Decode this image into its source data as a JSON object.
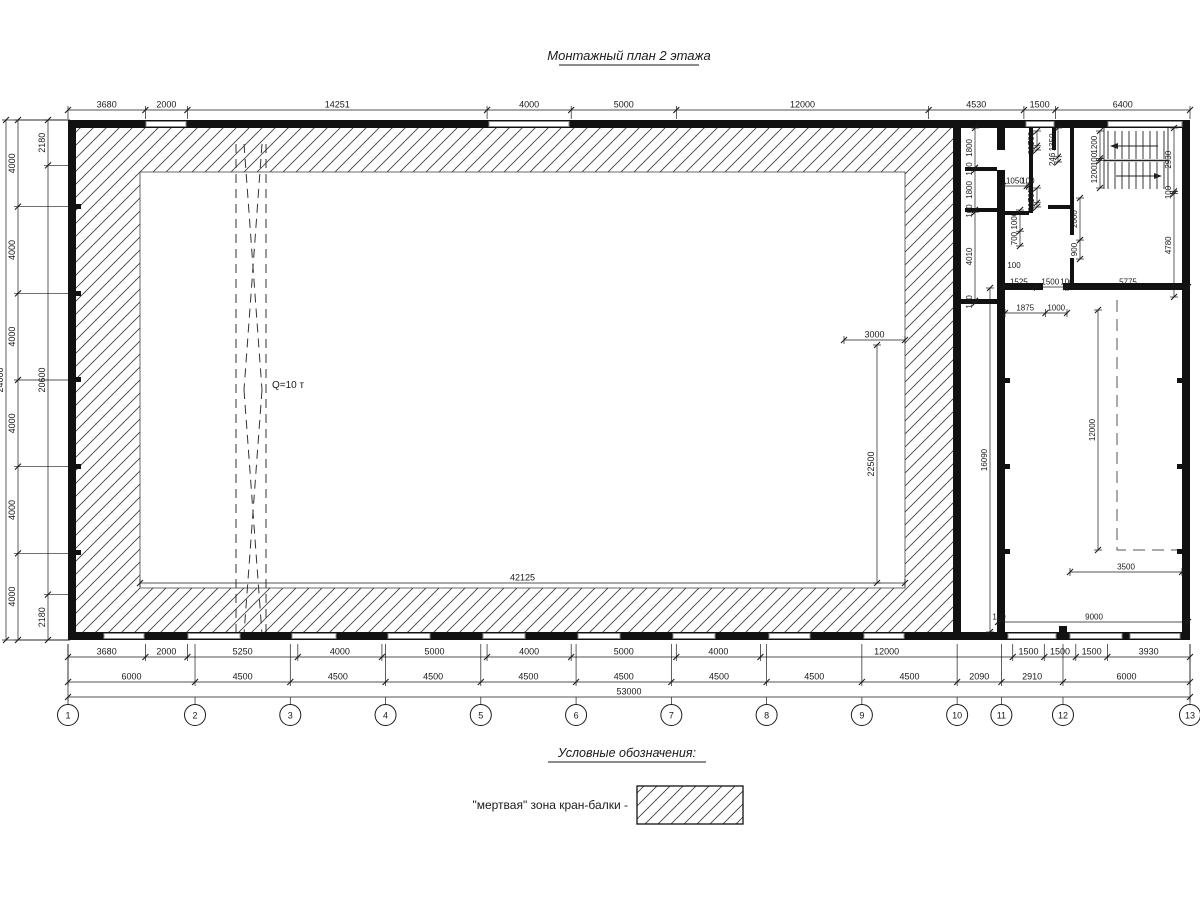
{
  "title": "Монтажный план 2 этажа",
  "crane": {
    "label": "Q=10 т"
  },
  "legend": {
    "heading": "Условные обозначения:",
    "dead_zone_label": "\"мертвая\" зона кран-балки -"
  },
  "axes": [
    "1",
    "2",
    "3",
    "4",
    "5",
    "6",
    "7",
    "8",
    "9",
    "10",
    "11",
    "12",
    "13"
  ],
  "colors": {
    "line": "#1a1a1a",
    "window": "#8c8c8c",
    "hatch": "#3a3a3a"
  },
  "dim_chains": [
    {
      "name": "top-row",
      "o": "h",
      "pos": 110,
      "from": 68,
      "to": 1190,
      "ext": 119,
      "fs": 9,
      "vals": [
        3680,
        2000,
        14251,
        4000,
        5000,
        12000,
        4530,
        1500,
        6400
      ]
    },
    {
      "name": "left-col-outer",
      "o": "v",
      "pos": 18,
      "from": 120,
      "to": 640,
      "ext": 70,
      "fs": 9,
      "vals": [
        4000,
        4000,
        4000,
        4000,
        4000,
        4000
      ]
    },
    {
      "name": "left-col-total",
      "o": "v",
      "pos": 6,
      "from": 120,
      "to": 640,
      "ext": 70,
      "fs": 9,
      "vals": [
        24000
      ]
    },
    {
      "name": "left-col-inner",
      "o": "v",
      "pos": 48,
      "from": 120,
      "to": 640,
      "ext": 70,
      "fs": 9,
      "vals": [
        2180,
        20600,
        2180
      ]
    },
    {
      "name": "bottom-row-1",
      "o": "h",
      "pos": 657,
      "from": 68,
      "to": 1190,
      "ext": 644,
      "fs": 9,
      "vals": [
        3680,
        2000,
        5250,
        4000,
        5000,
        4000,
        5000,
        4000,
        12000,
        1500,
        1500,
        1500,
        3930
      ]
    },
    {
      "name": "bottom-row-2",
      "o": "h",
      "pos": 682,
      "from": 68,
      "to": 1190,
      "ext": 644,
      "fs": 9,
      "vals": [
        6000,
        4500,
        4500,
        4500,
        4500,
        4500,
        4500,
        4500,
        4500,
        2090,
        2910,
        6000
      ]
    },
    {
      "name": "bottom-row-3",
      "o": "h",
      "pos": 697,
      "from": 68,
      "to": 1190,
      "ext": 644,
      "fs": 9,
      "vals": [
        53000
      ]
    },
    {
      "name": "crane-zone-width",
      "o": "h",
      "pos": 583,
      "from": 140,
      "to": 905,
      "fs": 9,
      "vals": [
        42125
      ]
    },
    {
      "name": "crane-zone-offset",
      "o": "h",
      "pos": 340,
      "from": 844,
      "to": 905,
      "fs": 9,
      "vals": [
        3000
      ]
    },
    {
      "name": "crane-zone-height",
      "o": "v",
      "pos": 877,
      "from": 345,
      "to": 583,
      "fs": 9,
      "vals": [
        22500
      ]
    },
    {
      "name": "right-room-height",
      "o": "v",
      "pos": 990,
      "from": 288,
      "to": 632,
      "fs": 8,
      "vals": [
        16090
      ]
    },
    {
      "name": "right-room-dashed-length",
      "o": "v",
      "pos": 1098,
      "from": 310,
      "to": 550,
      "fs": 8,
      "vals": [
        12000
      ]
    },
    {
      "name": "right-room-dashed-offset",
      "o": "h",
      "pos": 572,
      "from": 1070,
      "to": 1182,
      "fs": 8,
      "vals": [
        3500
      ]
    },
    {
      "name": "right-room-width",
      "o": "h",
      "pos": 622,
      "from": 998,
      "to": 1188,
      "fs": 8,
      "vals": [
        100,
        9000
      ]
    },
    {
      "name": "corridor-rooms",
      "o": "v",
      "pos": 975,
      "from": 128,
      "to": 303,
      "ext": null,
      "fs": 8,
      "vals": [
        1800,
        100,
        1800,
        100,
        4010,
        100
      ]
    },
    {
      "name": "stairwell-outer",
      "o": "v",
      "pos": 1174,
      "from": 128,
      "to": 297,
      "fs": 8,
      "vals": [
        2930,
        100,
        4780
      ]
    },
    {
      "name": "room-door",
      "o": "h",
      "pos": 186,
      "from": 1003,
      "to": 1029,
      "fs": 8,
      "vals": [
        1050,
        100
      ]
    },
    {
      "name": "rooms-bottom",
      "o": "h",
      "pos": 287,
      "from": 1003,
      "to": 1188,
      "fs": 8,
      "vals": [
        1525,
        1500,
        100,
        5775
      ]
    },
    {
      "name": "rooms-bottom-2",
      "o": "h",
      "pos": 313,
      "from": 1005,
      "to": 1067,
      "fs": 8,
      "vals": [
        1875,
        1000
      ]
    },
    {
      "name": "partition-top",
      "o": "v",
      "pos": 1037,
      "from": 131,
      "to": 150,
      "fs": 8,
      "vals": [
        700,
        200
      ]
    },
    {
      "name": "stair-entry",
      "o": "v",
      "pos": 1058,
      "from": 128,
      "to": 162,
      "fs": 8,
      "vals": [
        1350,
        246
      ]
    },
    {
      "name": "stair-flights",
      "o": "v",
      "pos": 1100,
      "from": 131,
      "to": 188,
      "fs": 8,
      "vals": [
        1200,
        100,
        1200
      ]
    },
    {
      "name": "partition-mid",
      "o": "v",
      "pos": 1037,
      "from": 188,
      "to": 207,
      "fs": 8,
      "vals": [
        700,
        200
      ]
    },
    {
      "name": "room-inner",
      "o": "v",
      "pos": 1020,
      "from": 210,
      "to": 246,
      "fs": 8,
      "vals": [
        1000,
        700
      ]
    },
    {
      "name": "room-inner-2",
      "o": "v",
      "pos": 1080,
      "from": 198,
      "to": 259,
      "fs": 8,
      "vals": [
        2000,
        900
      ]
    }
  ],
  "float_labels": [
    {
      "text": "100",
      "x": 1014,
      "y": 268
    }
  ]
}
